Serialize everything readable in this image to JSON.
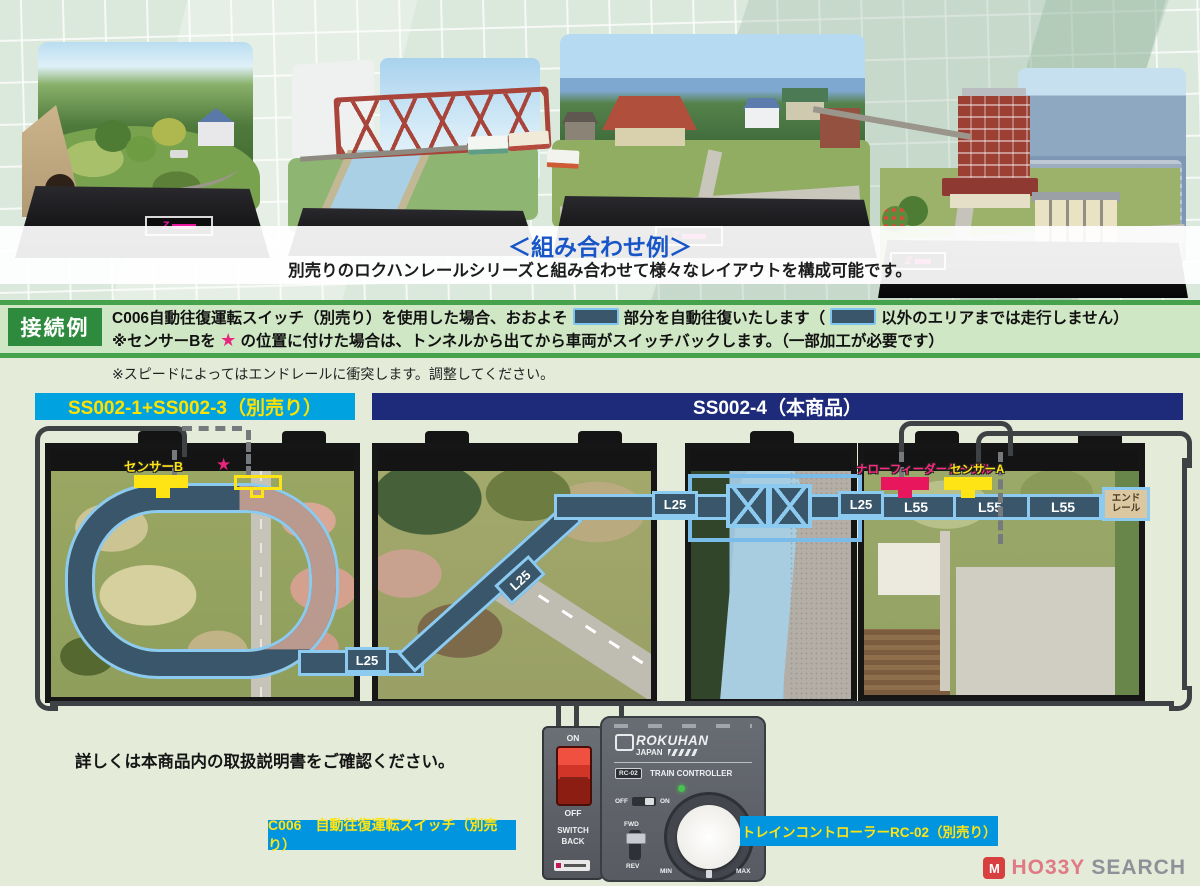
{
  "collage": {
    "caption_title": "＜組み合わせ例＞",
    "caption_body": "別売りのロクハンレールシリーズと組み合わせて様々なレイアウトを構成可能です。",
    "base_logo": "Z"
  },
  "info_bar": {
    "badge": "接続例",
    "line1_pre": "C006自動往復運転スイッチ（別売り）を使用した場合、おおよそ",
    "line1_mid": "部分を自動往復いたします（",
    "line1_post": "以外のエリアまでは走行しません）",
    "line2_pre": "※センサーBを",
    "line2_star": "★",
    "line2_post": "の位置に付けた場合は、トンネルから出てから車両がスイッチバックします。（一部加工が必要です）",
    "note": "※スピードによってはエンドレールに衝突します。調整してください。"
  },
  "section_headers": {
    "left": "SS002-1+SS002-3（別売り）",
    "right": "SS002-4（本商品）"
  },
  "diagram": {
    "sensor_b": "センサーB",
    "sensor_a": "センサーA",
    "feeder": "ナローフィーダーケーブル",
    "star": "★",
    "l25": "L25",
    "l55": "L55",
    "end_rail_line1": "エンド",
    "end_rail_line2": "レール"
  },
  "devices": {
    "switch_on": "ON",
    "switch_off": "OFF",
    "switch_name1": "SWITCH",
    "switch_name2": "BACK",
    "brand": "ROKUHAN",
    "brand_sub": "JAPAN",
    "model_badge": "RC-02",
    "controller_type": "TRAIN CONTROLLER",
    "fwd": "FWD",
    "rev": "REV",
    "min": "MIN",
    "max": "MAX",
    "slide_off": "OFF",
    "slide_on": "ON"
  },
  "footer": {
    "note": "詳しくは本商品内の取扱説明書をご確認ください。",
    "label_switch": "C006　自動往復運転スイッチ（別売り）",
    "label_controller": "トレインコントローラーRC-02（別売り）"
  },
  "watermark": {
    "icon_letter": "M",
    "brand_left": "HO33Y",
    "brand_right": "SEARCH"
  },
  "colors": {
    "accent_cyan": "#00a3e0",
    "navy": "#1d2b7a",
    "track_fill": "#3a566a",
    "track_edge": "#8ccaf0",
    "sensor_yellow": "#ffe415",
    "feeder_pink": "#e8175d",
    "badge_green": "#2e8b3d",
    "label_yellow": "#ffe100"
  }
}
